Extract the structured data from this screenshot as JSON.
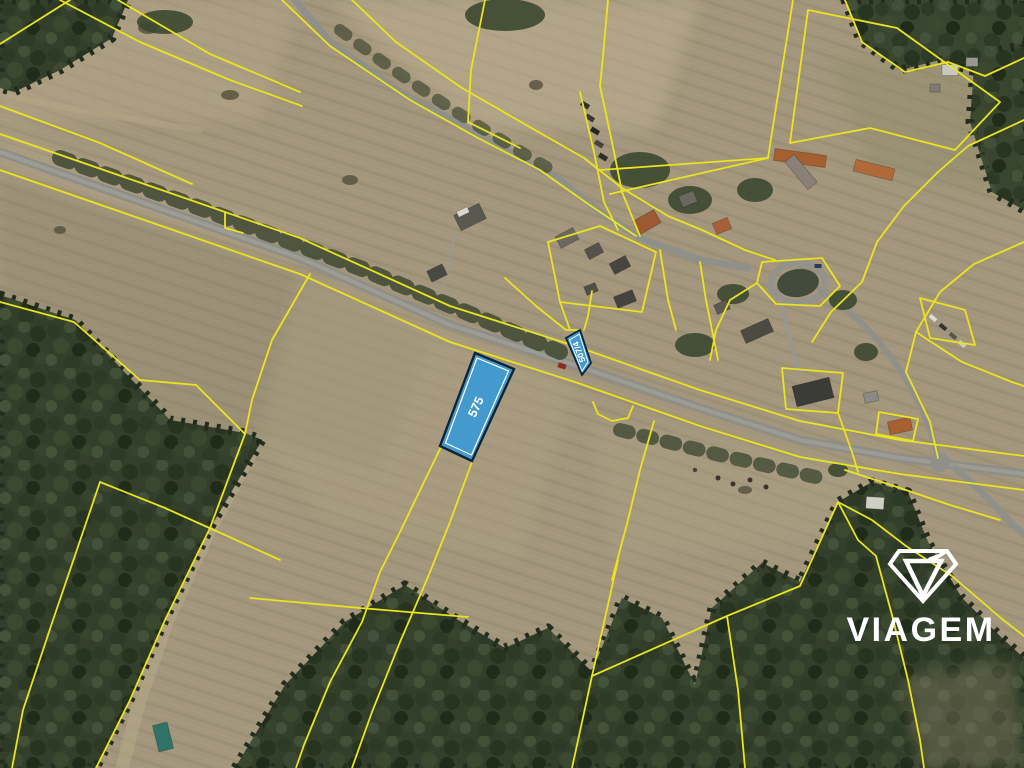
{
  "map": {
    "type": "satellite-cadastral-view",
    "highlighted_parcels": [
      {
        "label": "575"
      },
      {
        "label": "507/4"
      }
    ]
  },
  "watermark": {
    "brand": "VIAGEM"
  },
  "colors": {
    "cadastral_line": "#e9e320",
    "parcel_fill": "#4499ce",
    "parcel_border": "#0f2433",
    "parcel_inner_line": "#ffffff",
    "parcel_label": "#ffffff",
    "watermark": "#ffffff"
  }
}
